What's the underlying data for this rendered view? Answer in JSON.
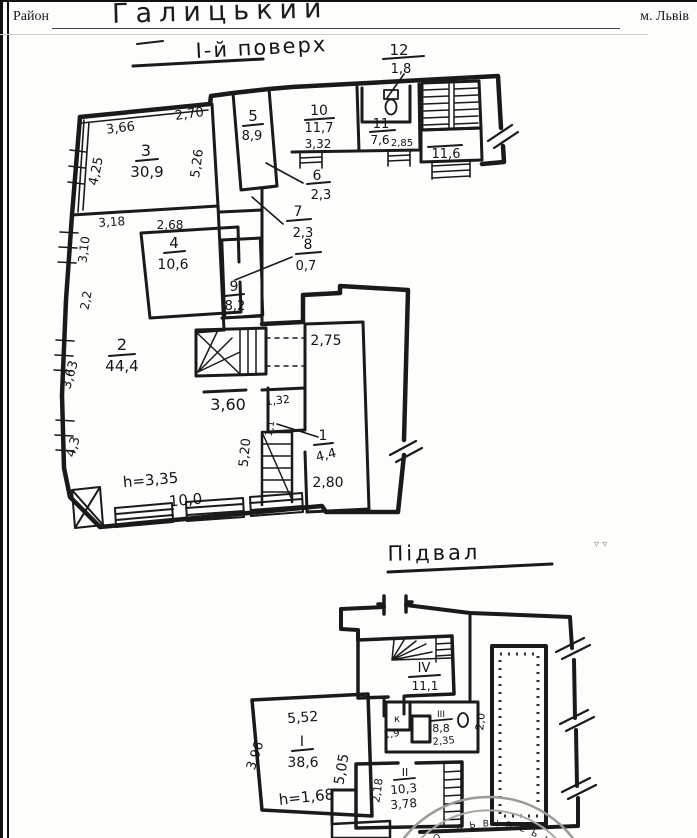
{
  "header": {
    "district_label": "Район",
    "district_value": "Галицький",
    "city": "м. Львів"
  },
  "floor1": {
    "title": "І-й поверх",
    "rooms": {
      "r1": {
        "num": "1",
        "area": "4,4"
      },
      "r2": {
        "num": "2",
        "area": "44,4"
      },
      "r3": {
        "num": "3",
        "area": "30,9"
      },
      "r4": {
        "num": "4",
        "area": "10,6"
      },
      "r5": {
        "num": "5",
        "area": "8,9"
      },
      "r6": {
        "num": "6",
        "area": "2,3"
      },
      "r7": {
        "num": "7",
        "area": "2,3"
      },
      "r8": {
        "num": "8",
        "area": "0,7"
      },
      "r9": {
        "num": "9",
        "area": "8,2"
      },
      "r10": {
        "num": "10",
        "area": "11,7"
      },
      "r11": {
        "num": "11",
        "area": "7,6"
      },
      "r12": {
        "num": "12",
        "area": "1,8"
      },
      "stair_hall_area": "11,6"
    },
    "dims": {
      "top_right": "2,70",
      "top_left": "3,66",
      "left_upper": "4,25",
      "room3_right": "5,26",
      "room10_width": "3,32",
      "room11_width": "2,85",
      "left_mid": "3,18",
      "left_mid_v": "3,10",
      "room4_width": "2,68",
      "left_22": "2,2",
      "left_363": "3,63",
      "left_43": "4,3",
      "mid_360": "3,60",
      "mid_132": "1,32",
      "corr_275": "2,75",
      "corr_280": "2,80",
      "v_520": "5,20",
      "v_11": "1,1",
      "bottom_100": "10,0"
    },
    "height_note": "h=3,35"
  },
  "basement": {
    "title": "Підвал",
    "rooms": {
      "rI": {
        "num": "I",
        "area": "38,6"
      },
      "rII": {
        "num": "II",
        "area": "10,3"
      },
      "rIII": {
        "num": "III",
        "area": "8,8"
      },
      "rIV": {
        "num": "IV",
        "area": "11,1"
      },
      "rK": {
        "num": "к",
        "area": "1,9"
      }
    },
    "dims": {
      "top_552": "5,52",
      "left_396": "3,96",
      "right_505": "5,05",
      "w_235": "2,35",
      "v_20": "2,0",
      "w_378": "3,78",
      "v_218": "2,18"
    },
    "height_note": "h=1,68"
  },
  "stamp": {
    "text": "· В О · Л Ь В І В С Ь К ·"
  },
  "artifacts": {
    "marks": "▿ ▿"
  }
}
